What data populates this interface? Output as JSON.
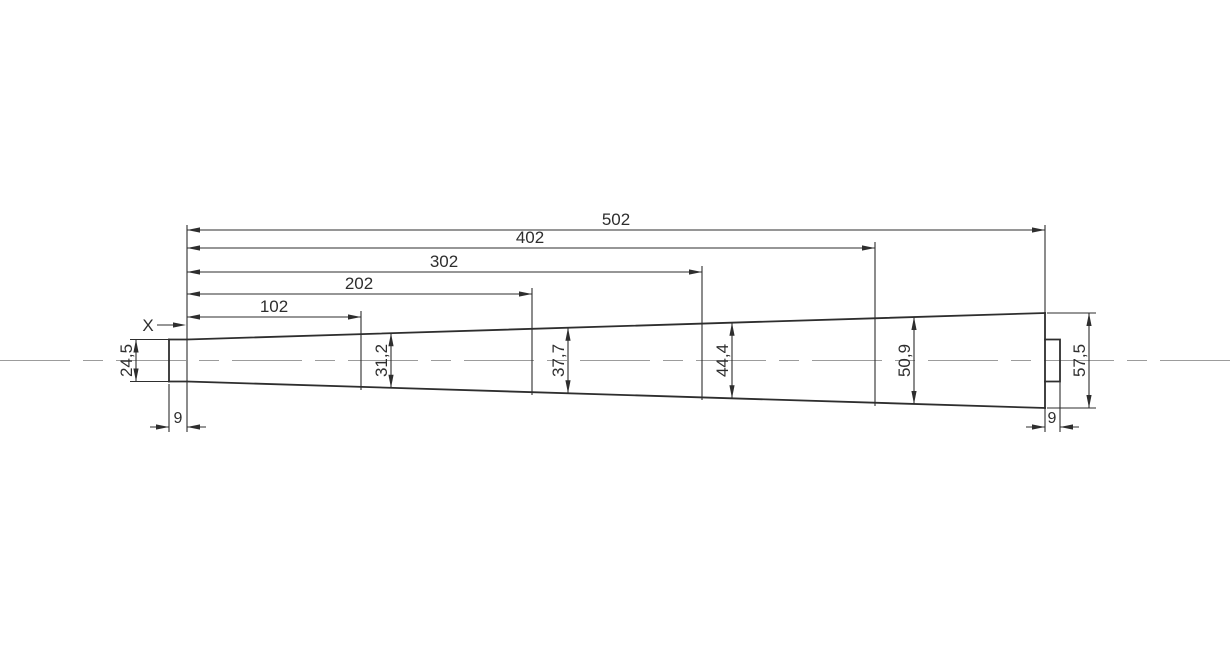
{
  "drawing": {
    "type": "technical-dimension-drawing",
    "part": "tapered-shaft-with-end-stubs",
    "marker": {
      "label": "X"
    },
    "dimensions": {
      "lengths": [
        {
          "label": "102"
        },
        {
          "label": "202"
        },
        {
          "label": "302"
        },
        {
          "label": "402"
        },
        {
          "label": "502"
        }
      ],
      "diameters": [
        {
          "label": "24,5"
        },
        {
          "label": "31,2"
        },
        {
          "label": "37,7"
        },
        {
          "label": "44,4"
        },
        {
          "label": "50,9"
        },
        {
          "label": "57,5"
        }
      ],
      "end_widths": [
        {
          "label": "9"
        },
        {
          "label": "9"
        }
      ]
    }
  },
  "colors": {
    "line": "#2e2e2e",
    "centerline": "#9c9c9c",
    "background": "#ffffff"
  }
}
